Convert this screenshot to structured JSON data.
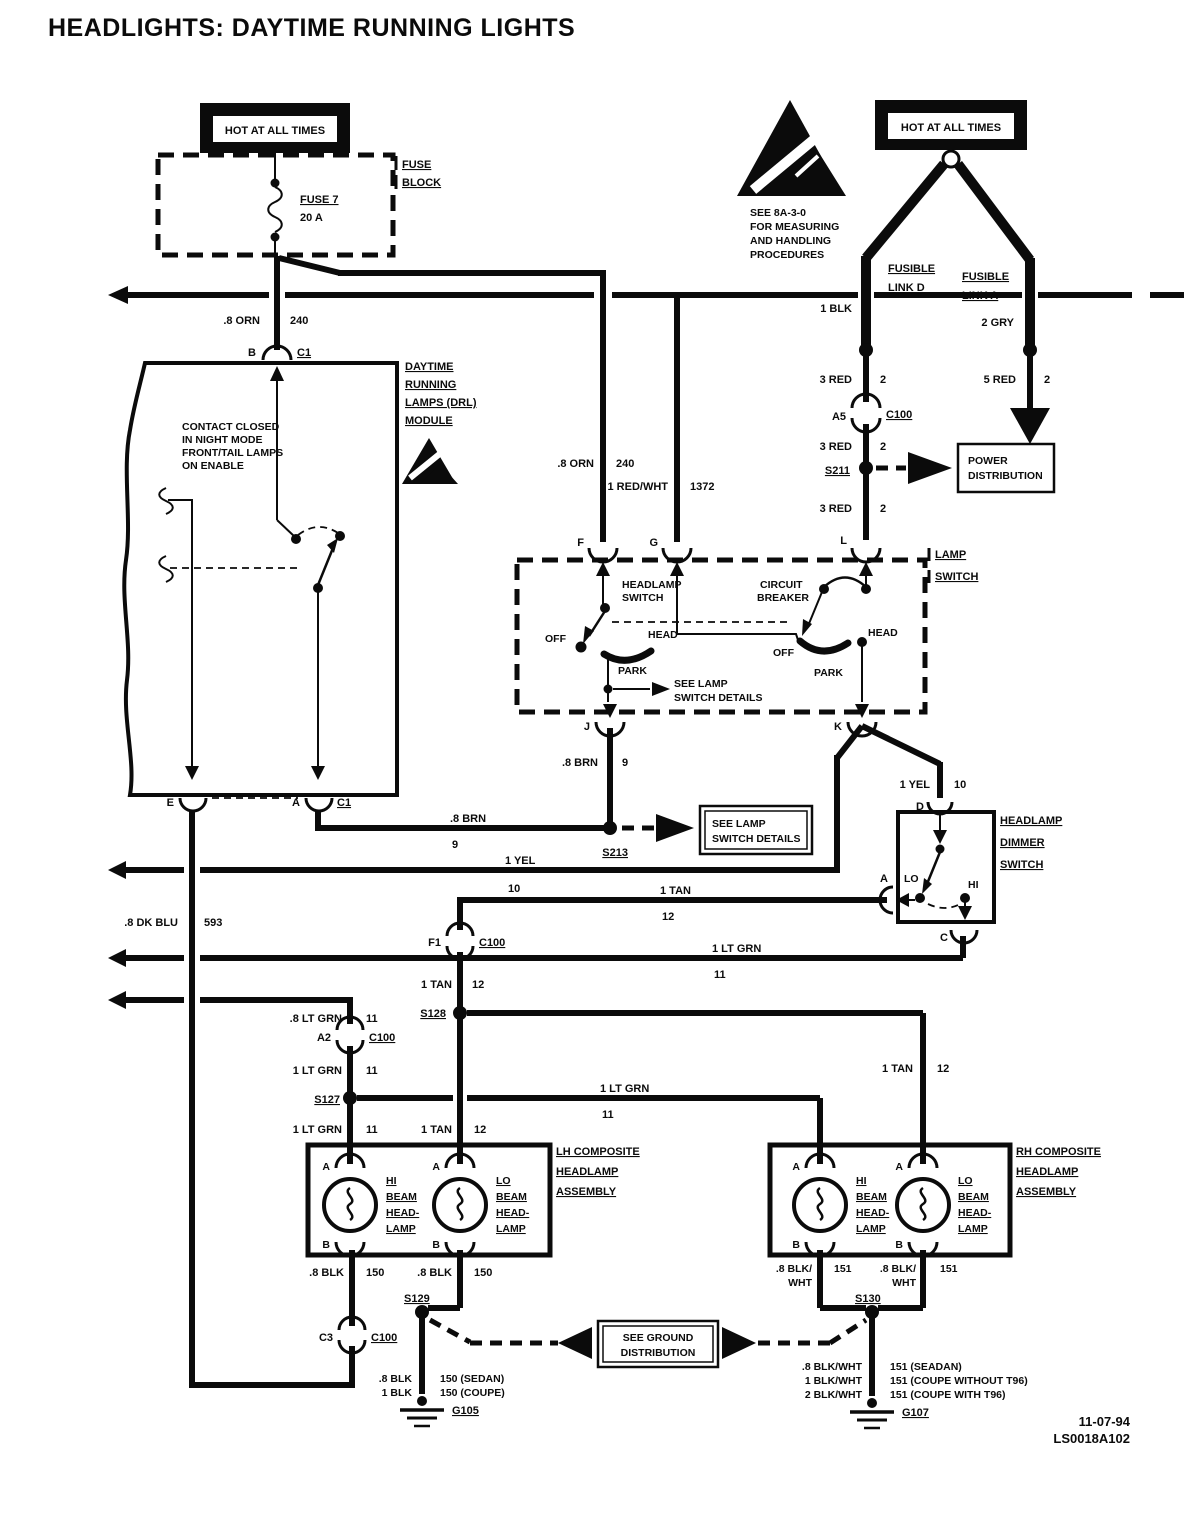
{
  "title": "HEADLIGHTS: DAYTIME RUNNING LIGHTS",
  "banners": {
    "hot_left": "HOT AT ALL TIMES",
    "hot_right": "HOT AT ALL TIMES"
  },
  "fuse_block": {
    "name1": "FUSE",
    "name2": "BLOCK",
    "fuse": "FUSE 7",
    "rating": "20 A"
  },
  "esd_note": {
    "l1": "SEE 8A-3-0",
    "l2": "FOR MEASURING",
    "l3": "AND HANDLING",
    "l4": "PROCEDURES"
  },
  "links": {
    "d1": "FUSIBLE",
    "d2": "LINK D",
    "a1": "FUSIBLE",
    "a2": "LINK A",
    "wire_d": "1 BLK",
    "wire_a": "2 GRY"
  },
  "wires": {
    "orn": {
      "a": ".8 ORN",
      "b": "240"
    },
    "red3": {
      "a": "3 RED",
      "b": "2"
    },
    "red5": {
      "a": "5 RED",
      "b": "2"
    },
    "redwht": {
      "a": "1 RED/WHT",
      "b": "1372"
    },
    "brn": {
      "a": ".8 BRN",
      "b": "9"
    },
    "yel": {
      "a": "1 YEL",
      "b": "10"
    },
    "dkblu": {
      "a": ".8 DK BLU",
      "b": "593"
    },
    "tan": {
      "a": "1 TAN",
      "b": "12"
    },
    "ltgrn": {
      "a": "1 LT GRN",
      "b": "11"
    },
    "ltgrn8": {
      "a": ".8 LT GRN",
      "b": "11"
    },
    "blk": {
      "a": ".8 BLK",
      "b": "150"
    },
    "blkwht": {
      "a": ".8 BLK/",
      "a2": "WHT",
      "b": "151"
    }
  },
  "connectors": {
    "b": "B",
    "c1": "C1",
    "a5": "A5",
    "c100": "C100",
    "f": "F",
    "g": "G",
    "l": "L",
    "j": "J",
    "k": "K",
    "e": "E",
    "a": "A",
    "d": "D",
    "c": "C",
    "f1": "F1",
    "a2": "A2",
    "c3": "C3",
    "hi_a": "A",
    "hi_b": "B"
  },
  "splices": {
    "s211": "S211",
    "s213": "S213",
    "s127": "S127",
    "s128": "S128",
    "s129": "S129",
    "s130": "S130"
  },
  "grounds": {
    "g105": "G105",
    "g107": "G107"
  },
  "drl_module": {
    "l1": "DAYTIME",
    "l2": "RUNNING",
    "l3": "LAMPS (DRL)",
    "l4": "MODULE",
    "note1": "CONTACT CLOSED",
    "note2": "IN NIGHT MODE",
    "note3": "FRONT/TAIL LAMPS",
    "note4": "ON ENABLE"
  },
  "lamp_switch": {
    "label1": "LAMP",
    "label2": "SWITCH",
    "hs1": "HEADLAMP",
    "hs2": "SWITCH",
    "cb1": "CIRCUIT",
    "cb2": "BREAKER",
    "off": "OFF",
    "head": "HEAD",
    "park": "PARK",
    "note1": "SEE LAMP",
    "note2": "SWITCH DETAILS"
  },
  "dimmer": {
    "l1": "HEADLAMP",
    "l2": "DIMMER",
    "l3": "SWITCH",
    "lo": "LO",
    "hi": "HI"
  },
  "boxes": {
    "power1": "POWER",
    "power2": "DISTRIBUTION",
    "see_lamp1": "SEE LAMP",
    "see_lamp2": "SWITCH DETAILS",
    "see_gnd1": "SEE GROUND",
    "see_gnd2": "DISTRIBUTION"
  },
  "assemblies": {
    "lh1": "LH COMPOSITE",
    "lh2": "HEADLAMP",
    "lh3": "ASSEMBLY",
    "rh1": "RH COMPOSITE",
    "rh2": "HEADLAMP",
    "rh3": "ASSEMBLY",
    "hi1": "HI",
    "hi2": "BEAM",
    "hi3": "HEAD-",
    "hi4": "LAMP",
    "lo1": "LO",
    "lo2": "BEAM",
    "lo3": "HEAD-",
    "lo4": "LAMP"
  },
  "ground_notes": {
    "l1a": ".8 BLK",
    "l1b": "150 (SEDAN)",
    "l2a": "1 BLK",
    "l2b": "150 (COUPE)",
    "r1a": ".8 BLK/WHT",
    "r1b": "151 (SEADAN)",
    "r2a": "1 BLK/WHT",
    "r2b": "151 (COUPE WITHOUT T96)",
    "r3a": "2 BLK/WHT",
    "r3b": "151 (COUPE WITH T96)"
  },
  "footer": {
    "date": "11-07-94",
    "code": "LS0018A102"
  }
}
